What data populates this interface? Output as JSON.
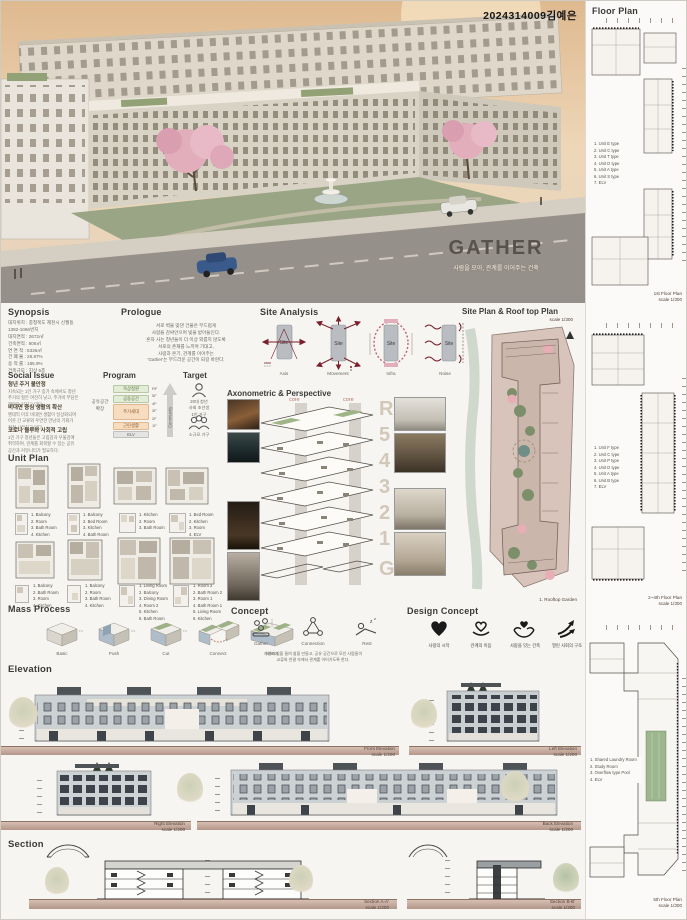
{
  "header": {
    "student_id": "2024314009김예은"
  },
  "hero": {
    "title": "GATHER",
    "subtitle": "사람을 모아, 관계를 이어주는 건축"
  },
  "synopsis": {
    "heading": "Synopsis",
    "lines": [
      "대지위치 : 충청북도 제천시 신월동",
      "1382-1066번지",
      "대지면적 : 2672㎡",
      "건축면적 : 806㎡",
      "연 면 적 : 5336㎡",
      "건 폐 율 : 28.87%",
      "용 적 률 : 185.9%",
      "건축규모 : 지상 5층"
    ]
  },
  "prologue": {
    "heading": "Prologue",
    "lines": [
      "서로 벽을 맞댄 건물은 부드럽게",
      "사람을 감싸안으며 빛을 받아들인다.",
      "혼자 사는 청년들이 더 이상 외롭지 않도록",
      "서로의 존재를 느끼며 기대고,",
      "사람과 온기, 관계를 이어주는",
      "'Gather'는 부드러운 공간이 되길 바란다."
    ]
  },
  "site_analysis": {
    "heading": "Site Analysis",
    "site": "Site",
    "labels": [
      "Axis",
      "Movement",
      "Infra",
      "Noise"
    ]
  },
  "site_plan": {
    "heading": "Site Plan & Roof top Plan",
    "scale": "scale 1/300",
    "caption": "1. Rooftop Garden"
  },
  "social_issue": {
    "heading": "Social Issue",
    "topics": [
      {
        "title": "청년 주거 불안정",
        "body": "지속되는 1인 가구 증가 속에서도 청년\n주거의 질은 여전히 낮고, 주거비 부담은\n해마다 커지고 있다."
      },
      {
        "title": "비대면 중심 생활의 확산",
        "body": "팬데믹 이후 비대면 생활이 일상화되며\n이웃 간 교류와 우연한 만남의 기회가\n점점 사라지고 있다."
      },
      {
        "title": "코로나 블루와 사회적 고립",
        "body": "1인 가구 청년들은 고립감과 우울감에\n취약하며, 관계를 회복할 수 있는 공유\n공간과 커뮤니티가 필요하다."
      }
    ]
  },
  "program": {
    "heading": "Program",
    "side_label": "공유공간\n확장",
    "rows": [
      {
        "label": "옥상정원"
      },
      {
        "label": "공용공간"
      },
      {
        "label": "주거세대"
      },
      {
        "label": "근린생활"
      },
      {
        "label": "ELV"
      }
    ],
    "floors": [
      "RF",
      "5F",
      "4F",
      "3F",
      "2F",
      "1F"
    ],
    "arrow_label": "Community"
  },
  "target": {
    "heading": "Target",
    "items": [
      {
        "lines": "20대 청년\n사회 초년생\n1인 가구"
      },
      {
        "lines": "소규모 가구"
      }
    ]
  },
  "unit_plan": {
    "heading": "Unit Plan",
    "units": [
      {
        "legend": "1. Balcony\n2. Room\n3. Bath Room\n4. Kitchen"
      },
      {
        "legend": "1. Balcony\n2. Bed Room\n3. Kitchen\n4. Bath Room"
      },
      {
        "legend": "1. Kitchen\n2. Room\n3. Bath Room"
      },
      {
        "legend": "1. Bed Room\n2. Kitchen\n3. Room\n4. ELV"
      },
      {
        "legend": "1. Balcony\n2. Bath Room\n3. Room\n4. Kitchen"
      },
      {
        "legend": "1. Balcony\n2. Room\n3. Bath Room\n4. Kitchen"
      },
      {
        "legend": "1. Living Room\n2. Balcony\n3. Dining Room\n4. Room 2\n5. Kitchen\n6. Bath Room"
      },
      {
        "legend": "1. Room 2\n2. Bath Room 2\n3. Room 1\n4. Bath Room 1\n5. Living Room\n6. Kitchen"
      }
    ]
  },
  "axon": {
    "heading": "Axonometric & Perspective",
    "core_left": "core",
    "core_right": "core",
    "floors": [
      "R",
      "5",
      "4",
      "3",
      "2",
      "1",
      "G"
    ]
  },
  "mass_process": {
    "heading": "Mass Process",
    "steps": [
      "Basic",
      "Push",
      "Cut",
      "Connect",
      "Mirror"
    ]
  },
  "concept": {
    "heading": "Concept",
    "items": [
      "Gather",
      "Connection",
      "Rest"
    ],
    "caption": "자연과 빛을 들여 쉼을 만들고, 공유 공간으로 모인 사람들이\n교류와 연결 속에서 관계를 이어가도록 한다."
  },
  "design_concept": {
    "heading": "Design Concept",
    "items": [
      "사랑의 시작",
      "관계의 이음",
      "사람을 잇는 건축",
      "열린 사회의 구조"
    ]
  },
  "elevation": {
    "heading": "Elevation",
    "items": [
      {
        "name": "Front Elevation",
        "scale": "scale 1/200"
      },
      {
        "name": "Left Elevation",
        "scale": "scale 1/200"
      },
      {
        "name": "Right Elevation",
        "scale": "scale 1/200"
      },
      {
        "name": "Back Elevation",
        "scale": "scale 1/200"
      }
    ]
  },
  "section": {
    "heading": "Section",
    "items": [
      {
        "name": "Section A-A'",
        "scale": "scale 1/200"
      },
      {
        "name": "Section B-B'",
        "scale": "scale 1/200"
      }
    ]
  },
  "floor_plan": {
    "heading": "Floor Plan",
    "plans": [
      {
        "caption": "1st Floor Plan",
        "scale": "scale 1/300",
        "legend": "1. Unit E type\n2. Unit C type\n3. Unit T type\n4. Unit D type\n5. Unit A type\n6. Unit S type\n7. ELV"
      },
      {
        "caption": "2~4th Floor Plan",
        "scale": "scale 1/300",
        "legend": "1. Unit F type\n2. Unit C type\n3. Unit P type\n4. Unit D type\n5. Unit A type\n6. Unit B type\n7. ELV"
      },
      {
        "caption": "5th Floor Plan",
        "scale": "scale 1/300",
        "legend": "1. Shared Laundry Room\n2. Study Room\n3. Overflow type Pool\n4. ELV"
      }
    ]
  },
  "colors": {
    "accent_red": "#7a1f2b",
    "program_green": "#e3ecd6",
    "program_orange": "#f8dcc0",
    "ground": "#c8a897",
    "sky": "#e7c49e",
    "title_gray": "#57524c"
  }
}
